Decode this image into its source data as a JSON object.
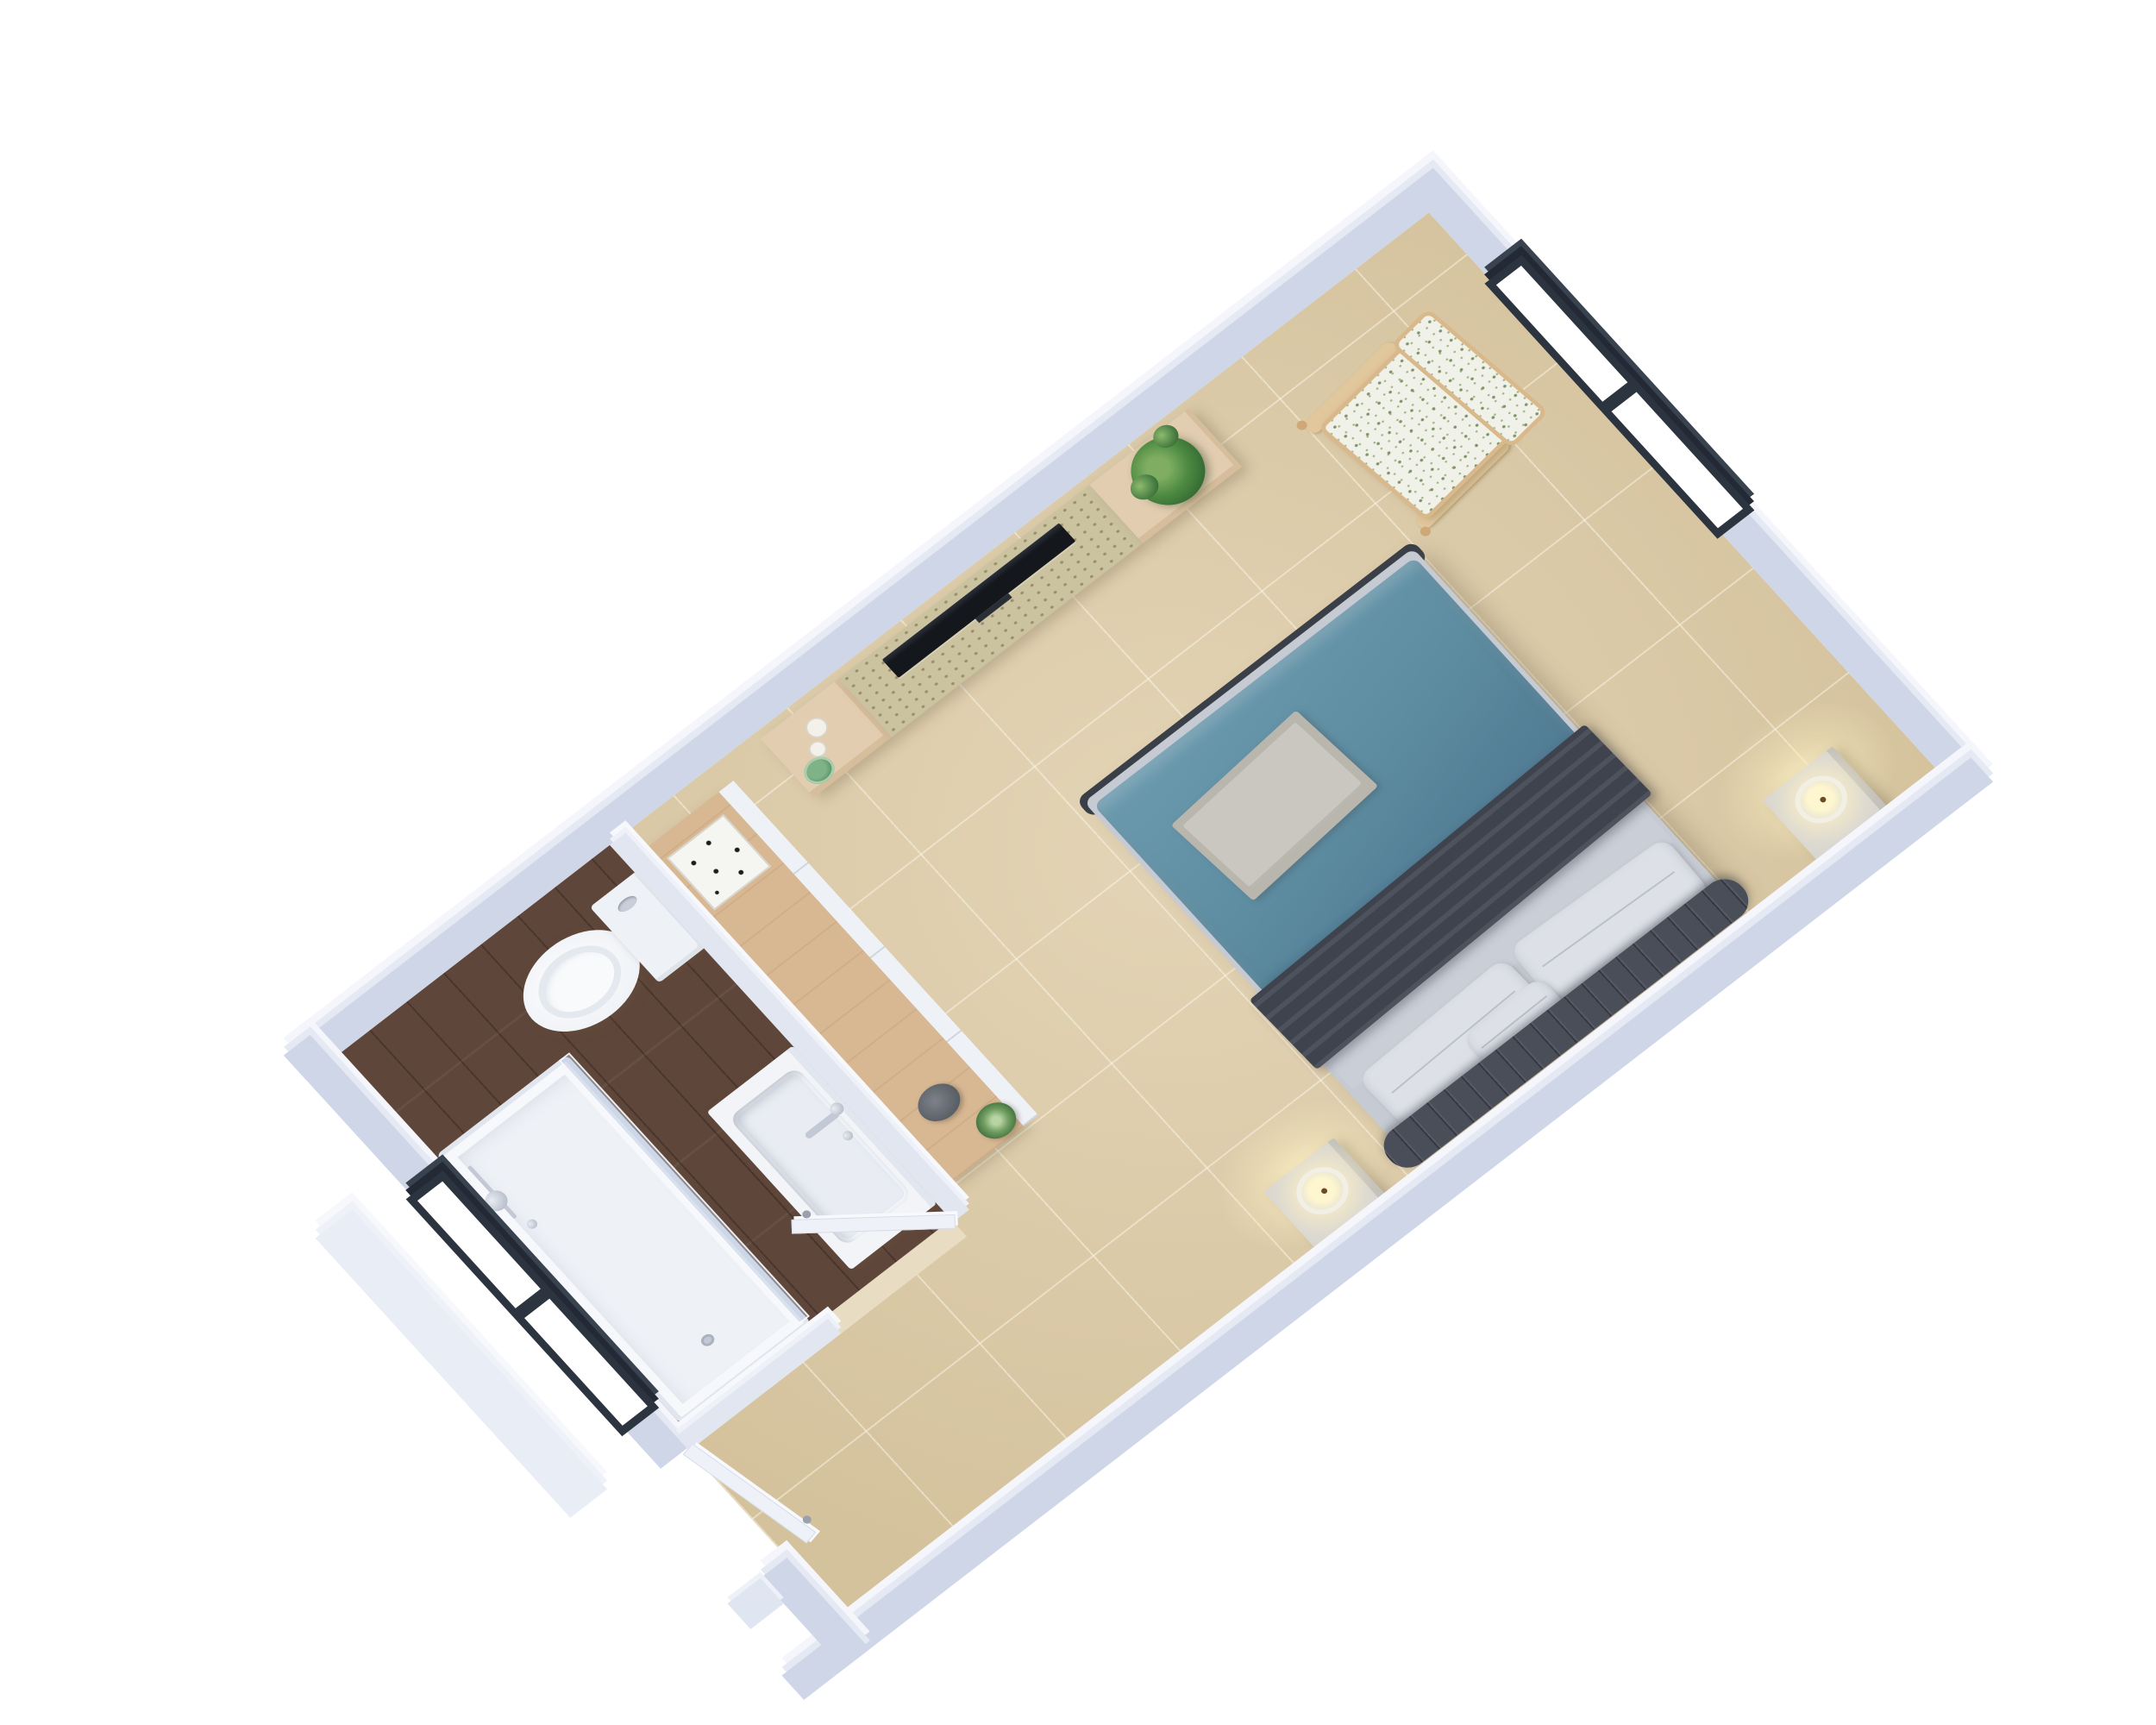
{
  "meta": {
    "render_type": "3d-floorplan-dimetric-top-view",
    "text_visible": "none"
  },
  "rooms": [
    {
      "name": "bedroom",
      "floor": "beige carpet tiles"
    },
    {
      "name": "bathroom",
      "floor": "dark walnut planks"
    },
    {
      "name": "entry-corridor",
      "floor": "beige carpet tiles"
    }
  ],
  "objects": [
    {
      "name": "double-bed",
      "parts": [
        "teal duvet",
        "folded gray towels",
        "charcoal throw blanket",
        "gray sheet",
        "two white pillows",
        "small pillow",
        "dark channel-tufted headboard"
      ]
    },
    {
      "name": "nightstand-left",
      "decor": "lit candle"
    },
    {
      "name": "nightstand-right",
      "decor": "lit candle"
    },
    {
      "name": "tv-console",
      "parts": [
        "oak end caps",
        "terrazzo middle",
        "flat tv",
        "potted plant",
        "two small candles",
        "green bowl"
      ]
    },
    {
      "name": "floral-armchair",
      "style": "white-green floral fabric, oak frame"
    },
    {
      "name": "dresser",
      "decor": [
        "star-pattern tray",
        "gray bowl",
        "succulent"
      ]
    },
    {
      "name": "toilet"
    },
    {
      "name": "sink-vanity",
      "parts": [
        "basin",
        "chrome faucet"
      ]
    },
    {
      "name": "walk-in-shower",
      "parts": [
        "white tray",
        "glass panel",
        "chrome shower head",
        "drain"
      ]
    },
    {
      "name": "window-upper-right",
      "panes": 2,
      "frame": "black"
    },
    {
      "name": "window-lower-left",
      "panes": 2,
      "frame": "black"
    },
    {
      "name": "bathroom-door",
      "state": "open"
    },
    {
      "name": "entry-door",
      "state": "ajar"
    }
  ],
  "palette": {
    "bg": "#ffffff",
    "wall-top": "#cfd6e7",
    "wall-face": "#f4f6fb",
    "wall-face-mid": "#e4e9f4",
    "wall-int": "#e2e6f1",
    "carpet": "#ddcba6",
    "wood": "#5f463a",
    "teal": "#5d8ca0",
    "teal-hi": "#6b9aae",
    "throw": "#3f434e",
    "headboard": "#4a4e59",
    "oak": "#e3cdb0",
    "oak-dark": "#d8b893",
    "win-frame": "#2c3440",
    "fixture": "#f4f6f9",
    "glass": "rgba(186,202,224,0.5)",
    "candle-glow": "#fdf6cf",
    "chair-wood": "#d9b98c"
  }
}
